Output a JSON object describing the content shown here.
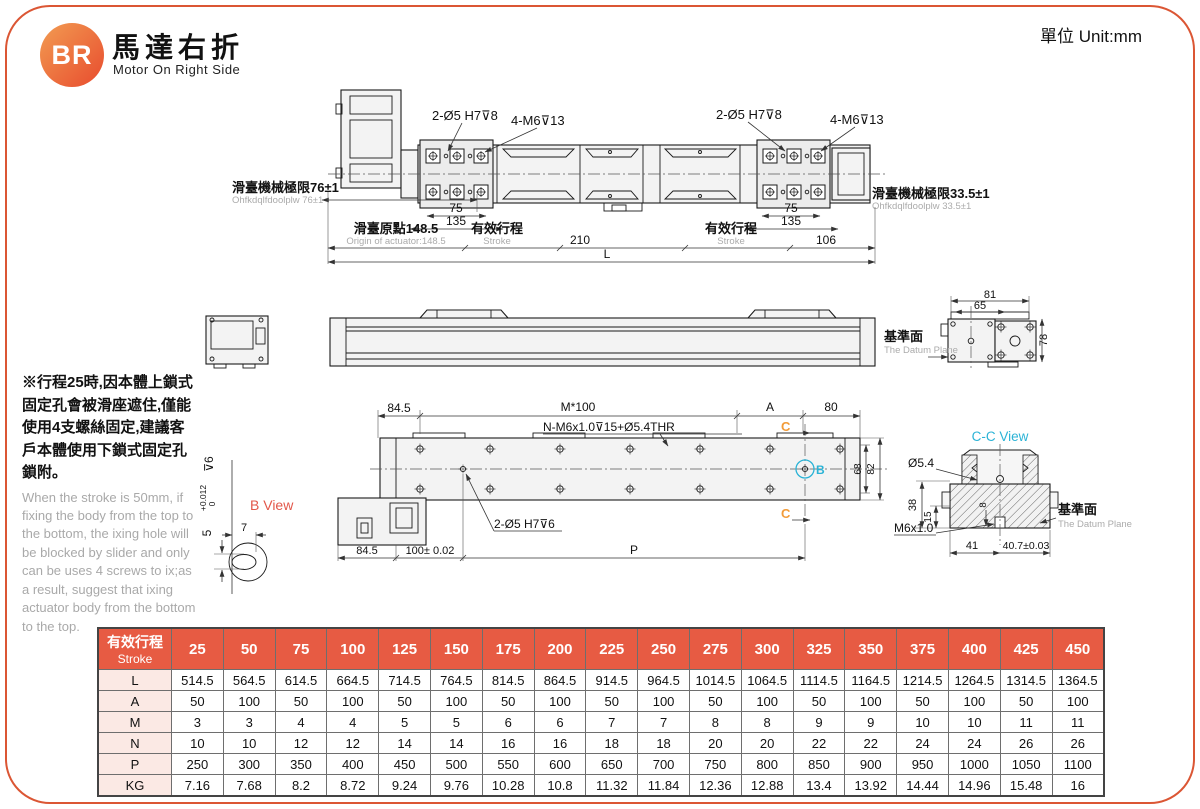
{
  "page": {
    "unit": "單位 Unit:mm"
  },
  "colors": {
    "accent": "#DB5634",
    "table_header": "#E75B43",
    "row_label_bg": "#FBE9E4",
    "cyan_label": "#2BB3D6",
    "orange_label": "#F29B38",
    "red_label": "#E2574A"
  },
  "header": {
    "logo": "BR",
    "title_zh": "馬達右折",
    "title_en": "Motor On Right Side"
  },
  "note": {
    "zh": "※行程25時,因本體上鎖式固定孔會被滑座遮住,僅能使用4支螺絲固定,建議客戶本體使用下鎖式固定孔鎖附。",
    "en": "When the stroke is 50mm, if fixing the body from the top to the bottom, the ixing hole will be blocked by slider and only can be uses 4 screws to ix;as a result, suggest that ixing actuator body from the bottom to the top."
  },
  "drawings": {
    "top": {
      "hole_l": "2-Ø5 H7⊽8",
      "screw_l": "4-M6⊽13",
      "hole_r": "2-Ø5 H7⊽8",
      "screw_r": "4-M6⊽13",
      "lim_l_zh": "滑臺機械極限76±1",
      "lim_l_en": "Ohfkdqlfdoolplw 76±1",
      "lim_r_zh": "滑臺機械極限33.5±1",
      "lim_r_en": "Ohfkdqlfdoolplw 33.5±1",
      "origin_zh": "滑臺原點148.5",
      "origin_en": "Origin of actuator:148.5",
      "stroke_zh": "有效行程",
      "stroke_en": "Stroke",
      "d75": "75",
      "d135": "135",
      "d210": "210",
      "d106": "106",
      "dL": "L"
    },
    "side": {
      "datum_zh": "基準面",
      "datum_en": "The Datum Plane",
      "d81": "81",
      "d65": "65",
      "d78": "78"
    },
    "bottom": {
      "d845_top": "84.5",
      "m100": "M*100",
      "nlabel": "N-M6x1.0⊽15+Ø5.4THR",
      "dA": "A",
      "d80": "80",
      "c": "C",
      "b": "B",
      "d68": "68",
      "d82": "82",
      "dowel": "2-Ø5 H7⊽6",
      "d845": "84.5",
      "d100": "100± 0.02",
      "dP": "P"
    },
    "bview": {
      "title": "B View",
      "d7": "7",
      "d5": "5",
      "tol_up": "+0.012",
      "tol_dn": "0",
      "depth": "⊽6"
    },
    "ccview": {
      "title": "C-C View",
      "d54": "Ø5.4",
      "d38": "38",
      "d15": "15",
      "d8": "8",
      "m6": "M6x1.0",
      "d41": "41",
      "d407": "40.7±0.03",
      "datum_zh": "基準面",
      "datum_en": "The Datum Plane"
    }
  },
  "table": {
    "head_zh": "有效行程",
    "head_en": "Stroke",
    "strokes": [
      "25",
      "50",
      "75",
      "100",
      "125",
      "150",
      "175",
      "200",
      "225",
      "250",
      "275",
      "300",
      "325",
      "350",
      "375",
      "400",
      "425",
      "450"
    ],
    "rows": [
      {
        "label": "L",
        "values": [
          "514.5",
          "564.5",
          "614.5",
          "664.5",
          "714.5",
          "764.5",
          "814.5",
          "864.5",
          "914.5",
          "964.5",
          "1014.5",
          "1064.5",
          "1114.5",
          "1164.5",
          "1214.5",
          "1264.5",
          "1314.5",
          "1364.5"
        ]
      },
      {
        "label": "A",
        "values": [
          "50",
          "100",
          "50",
          "100",
          "50",
          "100",
          "50",
          "100",
          "50",
          "100",
          "50",
          "100",
          "50",
          "100",
          "50",
          "100",
          "50",
          "100"
        ]
      },
      {
        "label": "M",
        "values": [
          "3",
          "3",
          "4",
          "4",
          "5",
          "5",
          "6",
          "6",
          "7",
          "7",
          "8",
          "8",
          "9",
          "9",
          "10",
          "10",
          "11",
          "11"
        ]
      },
      {
        "label": "N",
        "values": [
          "10",
          "10",
          "12",
          "12",
          "14",
          "14",
          "16",
          "16",
          "18",
          "18",
          "20",
          "20",
          "22",
          "22",
          "24",
          "24",
          "26",
          "26"
        ]
      },
      {
        "label": "P",
        "values": [
          "250",
          "300",
          "350",
          "400",
          "450",
          "500",
          "550",
          "600",
          "650",
          "700",
          "750",
          "800",
          "850",
          "900",
          "950",
          "1000",
          "1050",
          "1100"
        ]
      },
      {
        "label": "KG",
        "values": [
          "7.16",
          "7.68",
          "8.2",
          "8.72",
          "9.24",
          "9.76",
          "10.28",
          "10.8",
          "11.32",
          "11.84",
          "12.36",
          "12.88",
          "13.4",
          "13.92",
          "14.44",
          "14.96",
          "15.48",
          "16"
        ]
      }
    ]
  }
}
